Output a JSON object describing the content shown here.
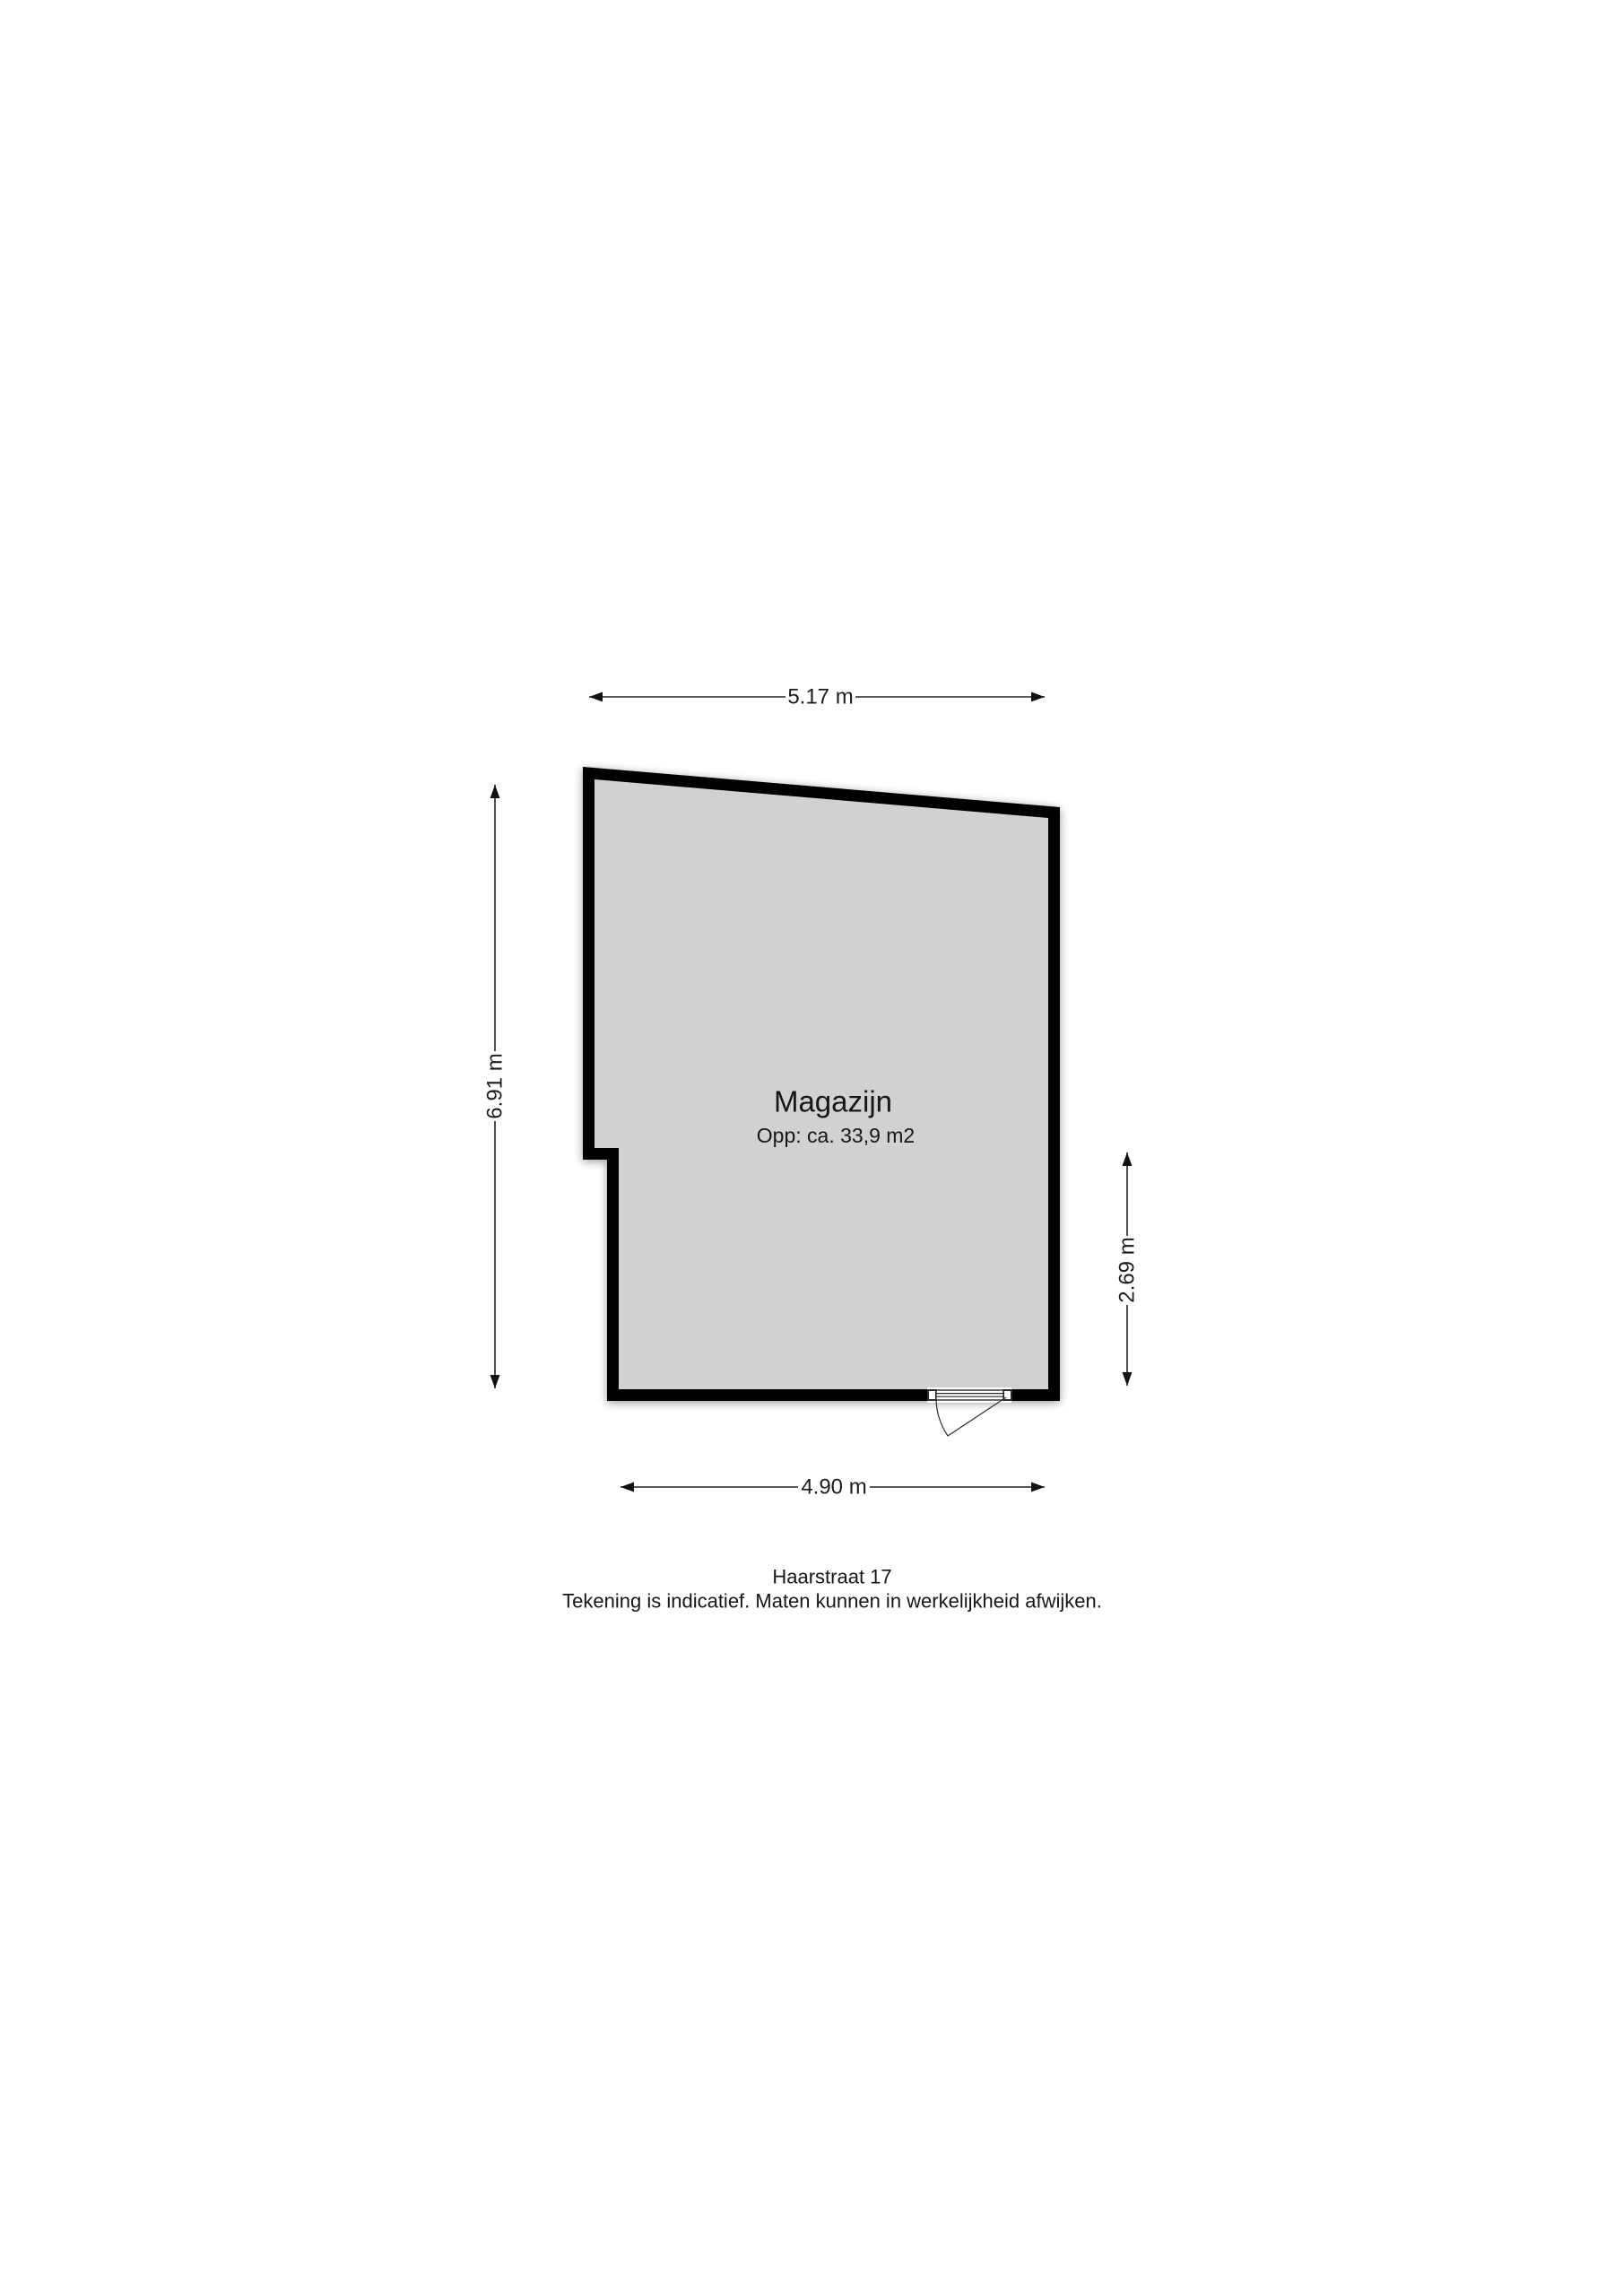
{
  "floorplan": {
    "room": {
      "name": "Magazijn",
      "area_label": "Opp: ca. 33,9 m2"
    },
    "dimensions": {
      "top": "5.17 m",
      "left": "6.91 m",
      "right": "2.69 m",
      "bottom": "4.90 m"
    },
    "footer": {
      "address": "Haarstraat 17",
      "disclaimer": "Tekening is indicatief. Maten kunnen in werkelijkheid afwijken."
    },
    "colors": {
      "wall": "#000000",
      "floor": "#d1d1d0",
      "background": "#ffffff"
    }
  }
}
